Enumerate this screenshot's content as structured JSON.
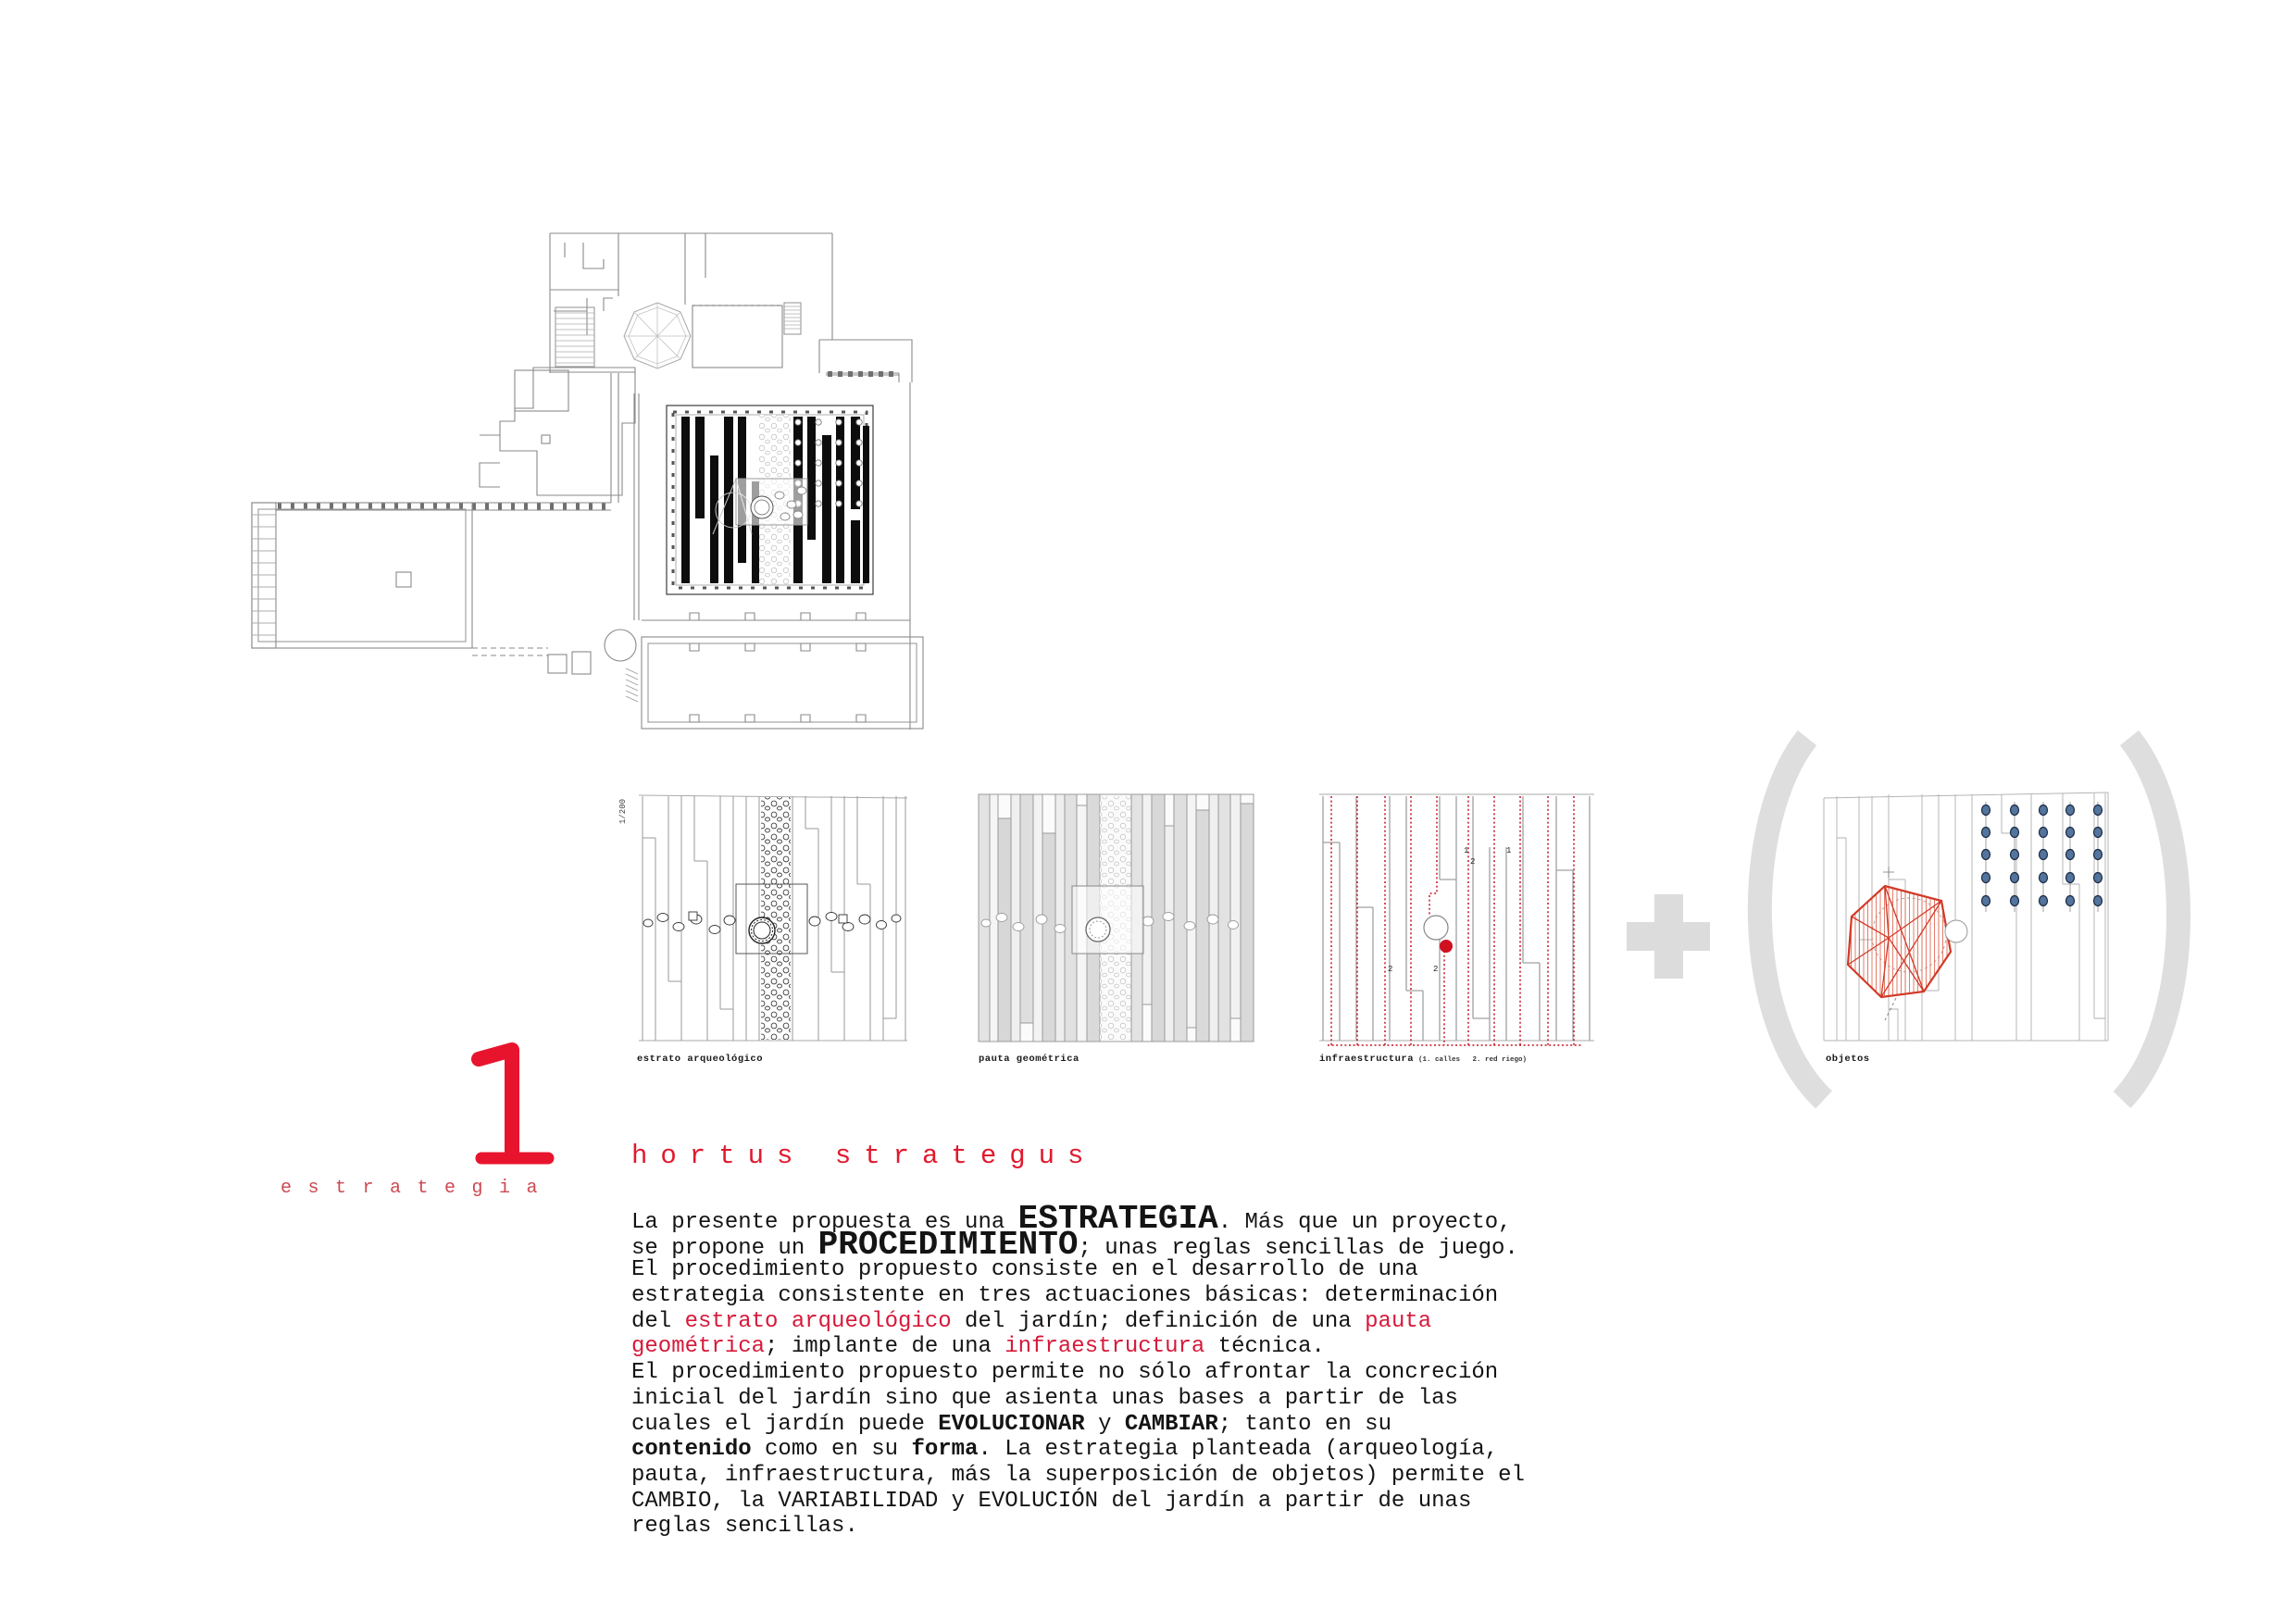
{
  "section": {
    "number": "1",
    "name": "estrategia"
  },
  "title": "hortus strategus",
  "panels": [
    {
      "label": "estrato arqueológico",
      "scale_label": "1/200"
    },
    {
      "label": "pauta geométrica"
    },
    {
      "label": "infraestructura",
      "sublabel": "(1. calles   2. red riego)",
      "markers": [
        "1",
        "2",
        "1",
        "2",
        "2"
      ]
    },
    {
      "label": "objetos"
    }
  ],
  "operators": {
    "plus": "+",
    "open_paren": "(",
    "close_paren": ")"
  },
  "colors": {
    "accent_red": "#e01a2e",
    "soft_red": "#cd4a52",
    "diagram_red": "#c41425",
    "object_red": "#d13a28",
    "paren_gray": "#dedede",
    "dot_blue": "#53749c",
    "plan_gray": "#8a8a8a",
    "bar_black": "#0d0d0d"
  },
  "body": {
    "lines": [
      [
        {
          "t": "La presente propuesta es una ",
          "s": "n"
        },
        {
          "t": "ESTRATEGIA",
          "s": "B"
        },
        {
          "t": ". Más que un proyecto,",
          "s": "n"
        }
      ],
      [
        {
          "t": "se propone un ",
          "s": "n"
        },
        {
          "t": "PROCEDIMIENTO",
          "s": "B"
        },
        {
          "t": "; unas reglas sencillas de juego.",
          "s": "n"
        }
      ],
      [
        {
          "t": "El procedimiento propuesto consiste en el desarrollo de una",
          "s": "n"
        }
      ],
      [
        {
          "t": "estrategia consistente en tres actuaciones básicas: determinación",
          "s": "n"
        }
      ],
      [
        {
          "t": "del ",
          "s": "n"
        },
        {
          "t": "estrato arqueológico",
          "s": "r"
        },
        {
          "t": " del jardín; definición de una ",
          "s": "n"
        },
        {
          "t": "pauta",
          "s": "r"
        }
      ],
      [
        {
          "t": "geométrica",
          "s": "r"
        },
        {
          "t": "; implante de una ",
          "s": "n"
        },
        {
          "t": "infraestructura",
          "s": "r"
        },
        {
          "t": " técnica.",
          "s": "n"
        }
      ],
      [
        {
          "t": "El procedimiento propuesto permite no sólo afrontar la concreción",
          "s": "n"
        }
      ],
      [
        {
          "t": "inicial del jardín sino que asienta unas bases a partir de las",
          "s": "n"
        }
      ],
      [
        {
          "t": "cuales el jardín puede ",
          "s": "n"
        },
        {
          "t": "EVOLUCIONAR",
          "s": "b"
        },
        {
          "t": " y ",
          "s": "n"
        },
        {
          "t": "CAMBIAR",
          "s": "b"
        },
        {
          "t": "; tanto en su",
          "s": "n"
        }
      ],
      [
        {
          "t": "contenido",
          "s": "b"
        },
        {
          "t": " como en su ",
          "s": "n"
        },
        {
          "t": "forma",
          "s": "b"
        },
        {
          "t": ". La estrategia planteada (arqueología,",
          "s": "n"
        }
      ],
      [
        {
          "t": "pauta, infraestructura, más la superposición de objetos) permite el",
          "s": "n"
        }
      ],
      [
        {
          "t": "CAMBIO, la VARIABILIDAD y EVOLUCIÓN del jardín a partir de unas",
          "s": "n"
        }
      ],
      [
        {
          "t": "reglas sencillas.",
          "s": "n"
        }
      ]
    ]
  }
}
